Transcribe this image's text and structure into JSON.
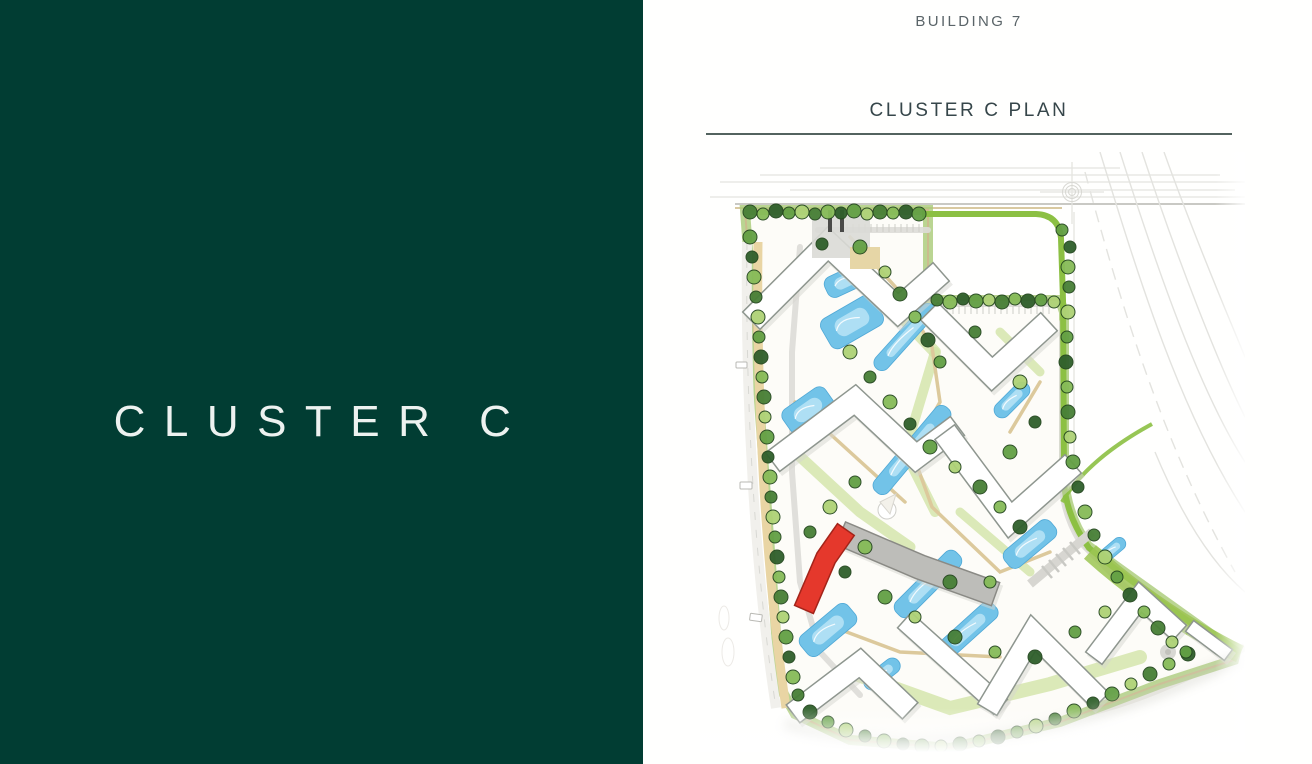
{
  "left_panel": {
    "title": "CLUSTER C"
  },
  "right_panel": {
    "building_label": "BUILDING 7",
    "plan_heading": "CLUSTER C PLAN"
  },
  "colors": {
    "panel_green": "#013D33",
    "panel_text": "#EDF2F0",
    "label_grey": "#5A6468",
    "heading_dark": "#36464A",
    "rule": "#53635F",
    "highlight_red": "#E5382C",
    "selected_grey": "#BDBDB9",
    "water": "#72C3E8",
    "water_light": "#B9E4F6",
    "water_stroke": "#4FA8D6"
  },
  "site_plan": {
    "label": "cluster-c-site-plan",
    "highlighted_building": "BUILDING 7",
    "illustration": {
      "tree_palette": [
        "#2f5f2b",
        "#477f36",
        "#63a044",
        "#86bb58",
        "#aed276",
        "#547c3c"
      ],
      "tree_stroke": "#24471f",
      "trees": [
        [
          50,
          60,
          7,
          1
        ],
        [
          63,
          62,
          6,
          3
        ],
        [
          76,
          59,
          7,
          0
        ],
        [
          89,
          61,
          6,
          2
        ],
        [
          102,
          60,
          7,
          4
        ],
        [
          115,
          62,
          6,
          1
        ],
        [
          128,
          60,
          7,
          3
        ],
        [
          141,
          61,
          6,
          0
        ],
        [
          154,
          59,
          7,
          2
        ],
        [
          167,
          62,
          6,
          4
        ],
        [
          180,
          60,
          7,
          1
        ],
        [
          193,
          61,
          6,
          3
        ],
        [
          206,
          60,
          7,
          0
        ],
        [
          219,
          62,
          7,
          2
        ],
        [
          237,
          148,
          6,
          1
        ],
        [
          250,
          150,
          7,
          3
        ],
        [
          263,
          147,
          6,
          0
        ],
        [
          276,
          149,
          7,
          2
        ],
        [
          289,
          148,
          6,
          4
        ],
        [
          302,
          150,
          7,
          1
        ],
        [
          315,
          147,
          6,
          3
        ],
        [
          328,
          149,
          7,
          0
        ],
        [
          341,
          148,
          6,
          2
        ],
        [
          354,
          150,
          6,
          4
        ],
        [
          50,
          85,
          7,
          2
        ],
        [
          52,
          105,
          6,
          0
        ],
        [
          54,
          125,
          7,
          3
        ],
        [
          56,
          145,
          6,
          1
        ],
        [
          58,
          165,
          7,
          4
        ],
        [
          59,
          185,
          6,
          2
        ],
        [
          61,
          205,
          7,
          0
        ],
        [
          62,
          225,
          6,
          3
        ],
        [
          64,
          245,
          7,
          1
        ],
        [
          65,
          265,
          6,
          4
        ],
        [
          67,
          285,
          7,
          2
        ],
        [
          68,
          305,
          6,
          0
        ],
        [
          70,
          325,
          7,
          3
        ],
        [
          71,
          345,
          6,
          1
        ],
        [
          73,
          365,
          7,
          4
        ],
        [
          75,
          385,
          6,
          2
        ],
        [
          77,
          405,
          7,
          0
        ],
        [
          79,
          425,
          6,
          3
        ],
        [
          81,
          445,
          7,
          1
        ],
        [
          83,
          465,
          6,
          4
        ],
        [
          86,
          485,
          7,
          2
        ],
        [
          89,
          505,
          6,
          0
        ],
        [
          93,
          525,
          7,
          3
        ],
        [
          98,
          543,
          6,
          1
        ],
        [
          110,
          560,
          7,
          0
        ],
        [
          128,
          570,
          6,
          2
        ],
        [
          146,
          578,
          7,
          4
        ],
        [
          165,
          584,
          6,
          1
        ],
        [
          184,
          589,
          7,
          3
        ],
        [
          203,
          592,
          6,
          0
        ],
        [
          222,
          594,
          7,
          2
        ],
        [
          241,
          594,
          6,
          4
        ],
        [
          260,
          592,
          7,
          1
        ],
        [
          279,
          589,
          6,
          3
        ],
        [
          298,
          585,
          7,
          0
        ],
        [
          317,
          580,
          6,
          2
        ],
        [
          336,
          574,
          7,
          4
        ],
        [
          355,
          567,
          6,
          1
        ],
        [
          374,
          559,
          7,
          3
        ],
        [
          393,
          551,
          6,
          0
        ],
        [
          412,
          542,
          7,
          2
        ],
        [
          431,
          532,
          6,
          4
        ],
        [
          450,
          522,
          7,
          1
        ],
        [
          469,
          512,
          6,
          3
        ],
        [
          488,
          502,
          7,
          0
        ],
        [
          362,
          78,
          6,
          2
        ],
        [
          370,
          95,
          6,
          0
        ],
        [
          368,
          115,
          7,
          3
        ],
        [
          369,
          135,
          6,
          1
        ],
        [
          368,
          160,
          7,
          4
        ],
        [
          367,
          185,
          6,
          2
        ],
        [
          366,
          210,
          7,
          0
        ],
        [
          367,
          235,
          6,
          3
        ],
        [
          368,
          260,
          7,
          1
        ],
        [
          370,
          285,
          6,
          4
        ],
        [
          373,
          310,
          7,
          2
        ],
        [
          378,
          335,
          6,
          0
        ],
        [
          385,
          360,
          7,
          3
        ],
        [
          394,
          383,
          6,
          1
        ],
        [
          405,
          405,
          7,
          4
        ],
        [
          417,
          425,
          6,
          2
        ],
        [
          430,
          443,
          7,
          0
        ],
        [
          444,
          460,
          6,
          3
        ],
        [
          458,
          476,
          7,
          1
        ],
        [
          472,
          490,
          6,
          4
        ],
        [
          486,
          500,
          6,
          2
        ],
        [
          122,
          92,
          6,
          0
        ],
        [
          160,
          95,
          7,
          2
        ],
        [
          185,
          120,
          6,
          4
        ],
        [
          200,
          142,
          7,
          1
        ],
        [
          215,
          165,
          6,
          3
        ],
        [
          228,
          188,
          7,
          0
        ],
        [
          240,
          210,
          6,
          2
        ],
        [
          150,
          200,
          7,
          4
        ],
        [
          170,
          225,
          6,
          1
        ],
        [
          190,
          250,
          7,
          3
        ],
        [
          210,
          272,
          6,
          0
        ],
        [
          230,
          295,
          7,
          2
        ],
        [
          255,
          315,
          6,
          4
        ],
        [
          280,
          335,
          7,
          1
        ],
        [
          300,
          355,
          6,
          3
        ],
        [
          320,
          375,
          7,
          0
        ],
        [
          155,
          330,
          6,
          2
        ],
        [
          130,
          355,
          7,
          4
        ],
        [
          110,
          380,
          6,
          1
        ],
        [
          165,
          395,
          7,
          3
        ],
        [
          145,
          420,
          6,
          0
        ],
        [
          185,
          445,
          7,
          2
        ],
        [
          215,
          465,
          6,
          4
        ],
        [
          255,
          485,
          7,
          1
        ],
        [
          295,
          500,
          6,
          3
        ],
        [
          335,
          505,
          7,
          0
        ],
        [
          375,
          480,
          6,
          2
        ],
        [
          405,
          460,
          6,
          4
        ],
        [
          250,
          430,
          7,
          1
        ],
        [
          290,
          430,
          6,
          3
        ],
        [
          310,
          300,
          7,
          2
        ],
        [
          335,
          270,
          6,
          0
        ],
        [
          320,
          230,
          7,
          4
        ],
        [
          275,
          180,
          6,
          1
        ]
      ],
      "pools": [
        [
          148,
          128,
          48,
          22,
          -25
        ],
        [
          152,
          170,
          60,
          34,
          -30
        ],
        [
          205,
          185,
          85,
          16,
          -48
        ],
        [
          108,
          258,
          52,
          28,
          -35
        ],
        [
          212,
          298,
          110,
          18,
          -50
        ],
        [
          312,
          248,
          44,
          16,
          -45
        ],
        [
          330,
          392,
          60,
          22,
          -40
        ],
        [
          228,
          432,
          85,
          20,
          -45
        ],
        [
          128,
          478,
          62,
          26,
          -40
        ],
        [
          268,
          478,
          72,
          20,
          -42
        ],
        [
          182,
          522,
          42,
          16,
          -38
        ],
        [
          412,
          398,
          32,
          13,
          -40
        ]
      ]
    }
  }
}
